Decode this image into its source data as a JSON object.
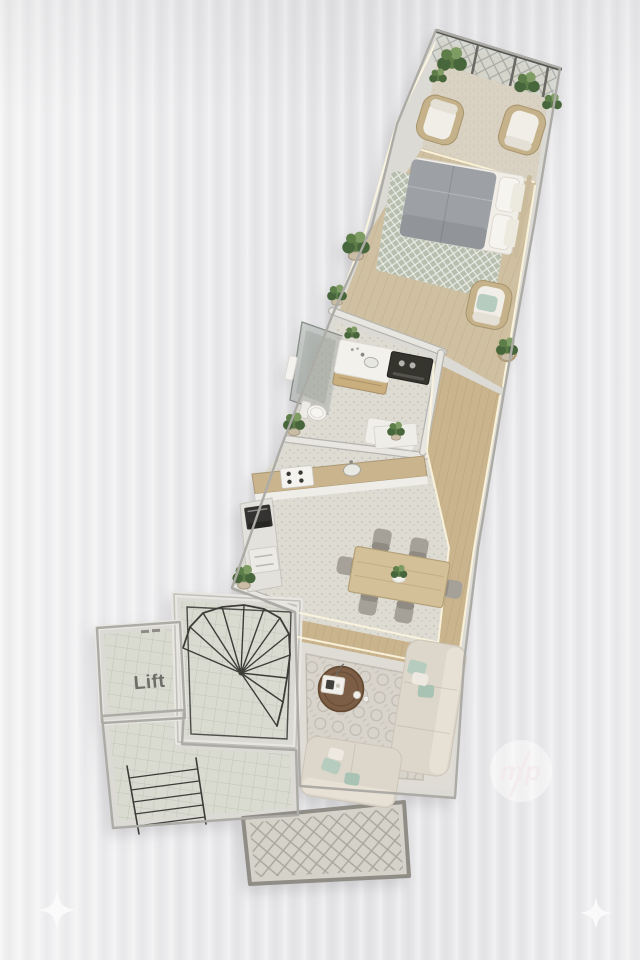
{
  "labels": {
    "lift": "Lift"
  },
  "watermark": {
    "text": "mp"
  },
  "decorations": {
    "corner_icon": "four-point-star-sparkle"
  },
  "colors": {
    "bg": "#e9e9eb",
    "wall": "#dcdad5",
    "wall_edge": "#adaba6",
    "wood": "#cfc0a1",
    "wood_warm": "#c9b48e",
    "wood_pale": "#d9d2c2",
    "tile": "#dedbd3",
    "tile_green": "#d9dbd1",
    "rug_sage": "#b9bfae",
    "rug_ornate": "#d8d3cb",
    "bed": "#9da0a4",
    "linen": "#f1eee8",
    "sofa": "#ddd6ca",
    "mint": "#b5ccbf",
    "plant": "#5d7d4a",
    "plant_dark": "#47663b",
    "metal": "#3e3d39",
    "table_wood": "#d3bf98",
    "chair_gray": "#a5a199",
    "led": "#fdf6df",
    "glass": "#b9beba",
    "lift_text": "#6e6d68",
    "watermark": "#f3ebee",
    "sparkle": "#fbfbfc"
  }
}
